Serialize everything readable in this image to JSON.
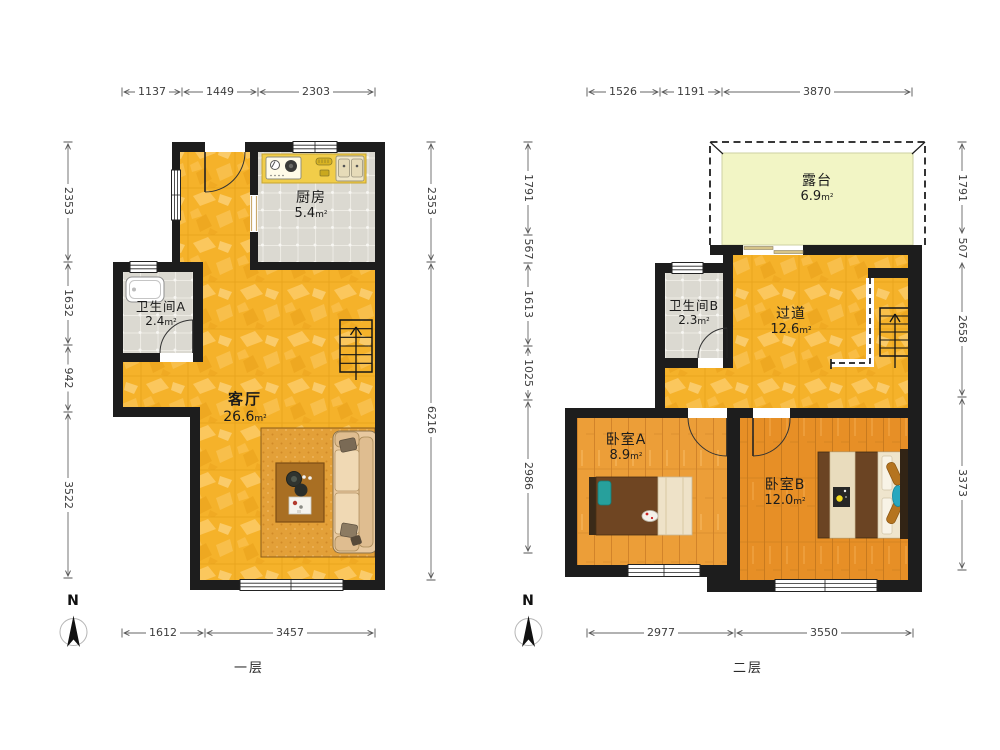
{
  "floors": [
    {
      "id": "floor1",
      "label": "一层",
      "compass_label": "N",
      "rooms": [
        {
          "name": "厨房",
          "area": "5.4",
          "unit": "m²"
        },
        {
          "name": "卫生间A",
          "area": "2.4",
          "unit": "m²"
        },
        {
          "name": "客厅",
          "area": "26.6",
          "unit": "m²"
        }
      ],
      "dims": {
        "top": [
          "1137",
          "1449",
          "2303"
        ],
        "left": [
          "2353",
          "1632",
          "942",
          "3522"
        ],
        "right": [
          "2353",
          "6216"
        ],
        "bottom": [
          "1612",
          "3457"
        ]
      }
    },
    {
      "id": "floor2",
      "label": "二层",
      "compass_label": "N",
      "rooms": [
        {
          "name": "露台",
          "area": "6.9",
          "unit": "m²"
        },
        {
          "name": "卫生间B",
          "area": "2.3",
          "unit": "m²"
        },
        {
          "name": "过道",
          "area": "12.6",
          "unit": "m²"
        },
        {
          "name": "卧室A",
          "area": "8.9",
          "unit": "m²"
        },
        {
          "name": "卧室B",
          "area": "12.0",
          "unit": "m²"
        }
      ],
      "dims": {
        "top": [
          "1526",
          "1191",
          "3870"
        ],
        "left": [
          "1791",
          "567",
          "1613",
          "1025",
          "2986"
        ],
        "right": [
          "1791",
          "507",
          "2658",
          "3373"
        ],
        "bottom": [
          "2977",
          "3550"
        ]
      }
    }
  ],
  "colors": {
    "wall": "#1d1d1d",
    "living_floor": "#f5b22a",
    "wood_floor_a": "#ec9e38",
    "wood_floor_b": "#e78f26",
    "tile_floor": "#dbd9d1",
    "terrace_floor": "#f2f5c5",
    "counter": "#f1cd49",
    "rug": "#e3a038",
    "sofa": "#e8c9a0",
    "dim_text": "#3d3d3d"
  }
}
